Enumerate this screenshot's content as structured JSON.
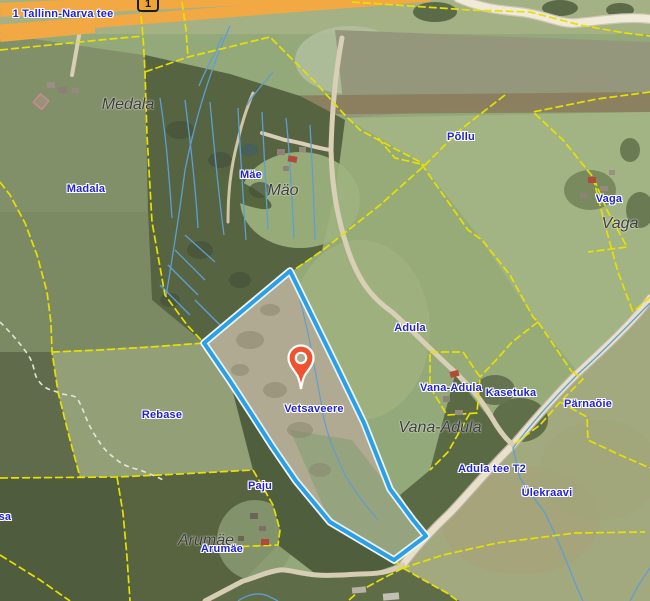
{
  "map": {
    "shield": {
      "text": "1"
    },
    "marker": {
      "x": 301,
      "y": 389,
      "color": "#f0512f"
    },
    "parcel": {
      "name": "Vetsaveere",
      "points": "290,271 337,367 364,423 390,489 413,520 426,536 394,560 330,522 296,481 272,446 256,421 230,381 204,343"
    },
    "colors": {
      "label-blue": "#2323cd",
      "settlement-text": "#3d3d3d",
      "cadastral-yellow": "#e8e000",
      "ditch-blue": "#5f9ed2",
      "parcel-blue": "#2b9fe8",
      "highway-orange": "#f2a843",
      "road-fill": "#ece4cf",
      "shield-fill": "#f0a530",
      "marker-red": "#f0512f"
    },
    "labels": {
      "items": [
        {
          "text": "1 Tallinn-Narva tee",
          "x": 63,
          "y": 14,
          "type": "road"
        },
        {
          "text": "Medala",
          "x": 128,
          "y": 105,
          "type": "settlement"
        },
        {
          "text": "Madala",
          "x": 86,
          "y": 189,
          "type": "cadastral"
        },
        {
          "text": "Mäe",
          "x": 251,
          "y": 175,
          "type": "cadastral"
        },
        {
          "text": "Mäo",
          "x": 283,
          "y": 191,
          "type": "settlement"
        },
        {
          "text": "Põllu",
          "x": 461,
          "y": 137,
          "type": "cadastral"
        },
        {
          "text": "Vaga",
          "x": 609,
          "y": 199,
          "type": "cadastral"
        },
        {
          "text": "Vaga",
          "x": 620,
          "y": 224,
          "type": "settlement"
        },
        {
          "text": "Adula",
          "x": 410,
          "y": 328,
          "type": "cadastral"
        },
        {
          "text": "Vana-Adula",
          "x": 451,
          "y": 388,
          "type": "cadastral"
        },
        {
          "text": "Vana-Adula",
          "x": 440,
          "y": 428,
          "type": "settlement"
        },
        {
          "text": "Kasetuka",
          "x": 511,
          "y": 393,
          "type": "cadastral"
        },
        {
          "text": "Pärnaõie",
          "x": 588,
          "y": 404,
          "type": "cadastral"
        },
        {
          "text": "Vetsaveere",
          "x": 314,
          "y": 409,
          "type": "cadastral"
        },
        {
          "text": "Adula tee T2",
          "x": 492,
          "y": 469,
          "type": "cadastral"
        },
        {
          "text": "Ülekraavi",
          "x": 547,
          "y": 493,
          "type": "cadastral"
        },
        {
          "text": "Rebase",
          "x": 162,
          "y": 415,
          "type": "cadastral"
        },
        {
          "text": "Paju",
          "x": 260,
          "y": 486,
          "type": "cadastral"
        },
        {
          "text": "Arumäe",
          "x": 206,
          "y": 541,
          "type": "settlement"
        },
        {
          "text": "Arumäe",
          "x": 222,
          "y": 549,
          "type": "cadastral"
        },
        {
          "text": "tsa",
          "x": 3,
          "y": 517,
          "type": "cadastral"
        }
      ]
    }
  }
}
